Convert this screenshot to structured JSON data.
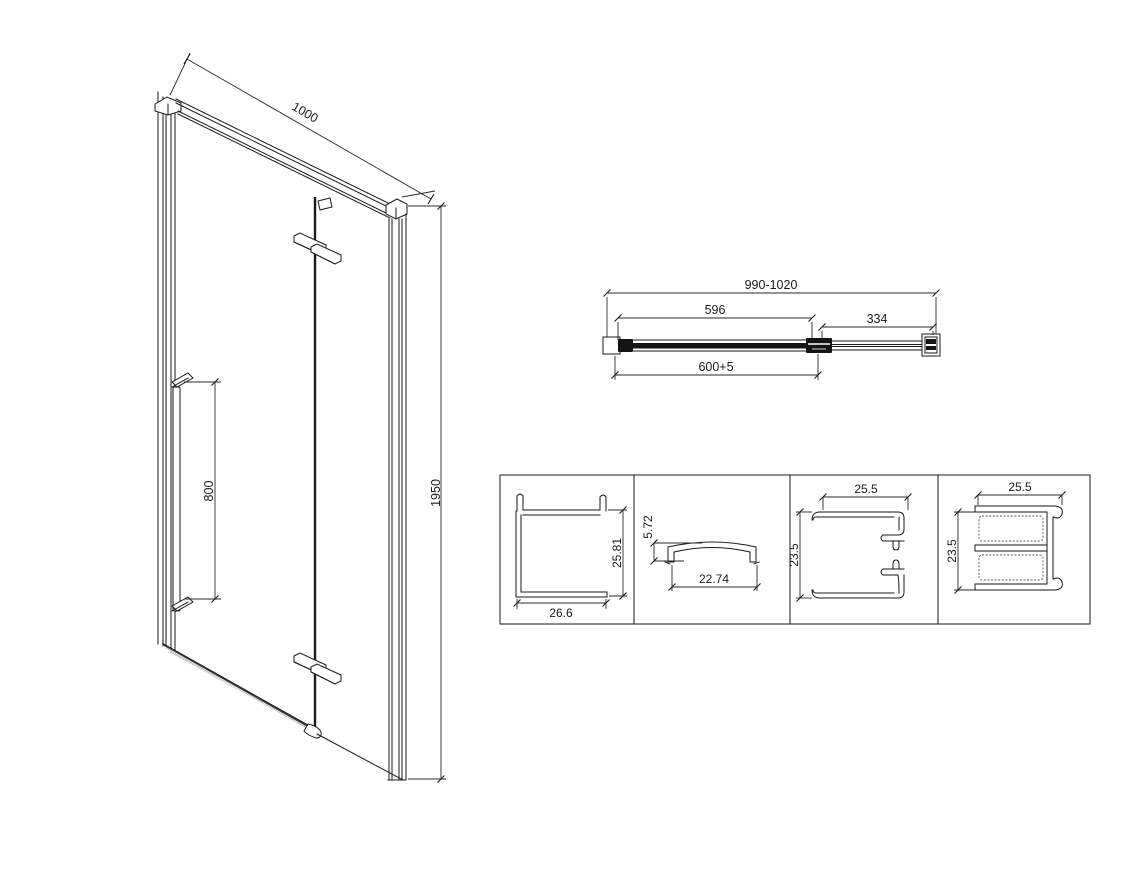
{
  "drawing": {
    "iso": {
      "width": "1000",
      "handle_height": "800",
      "total_height": "1950"
    },
    "plan": {
      "overall_range": "990-1020",
      "door_glass": "596",
      "fixed_panel": "334",
      "adjustment": "600+5"
    },
    "details": {
      "wall_profile": {
        "width": "26.6",
        "height": "25.81"
      },
      "cap_profile": {
        "height": "5.72",
        "width": "22.74"
      },
      "door_profile": {
        "width": "25.5",
        "height": "23.5"
      },
      "panel_profile": {
        "width": "25.5",
        "height": "23.5"
      }
    }
  },
  "colors": {
    "line": "#1a1a1a",
    "background": "#ffffff"
  }
}
